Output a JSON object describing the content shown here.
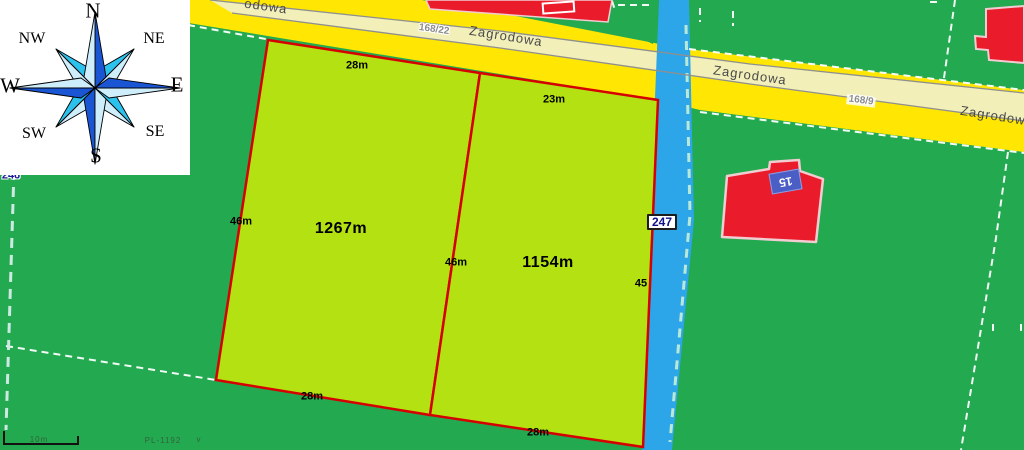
{
  "map_title": "cadastral parcel map",
  "compass": {
    "n": "N",
    "ne": "NE",
    "e": "E",
    "se": "SE",
    "s": "S",
    "sw": "SW",
    "w": "W",
    "nw": "NW"
  },
  "roads": {
    "name": "Zagrodowa",
    "name_partial": "odowa",
    "plot_number_left": "168/22",
    "plot_number_right": "168/9"
  },
  "parcels": {
    "parcel1": {
      "area_label": "1267m",
      "top": "28m",
      "left": "46m",
      "right": "46m",
      "bottom": "28m"
    },
    "parcel2": {
      "area_label": "1154m",
      "top": "23m",
      "right": "45",
      "bottom": "28m"
    }
  },
  "waterway": {
    "number": "247"
  },
  "neighbor_parcel_number": "246",
  "building": {
    "house_number": "15"
  },
  "scale_bar": {
    "label": "10m"
  },
  "watermark": {
    "text": "PL-1192",
    "mark": "v"
  },
  "colors": {
    "field_green": "#23a950",
    "parcel_green": "#b4e112",
    "road_yellow": "#ffe703",
    "road_center_band": "#f2efb9",
    "water_blue": "#2ca6e8",
    "parcel_border_red": "#d60000",
    "building_red": "#ea1c2c",
    "house_badge_blue": "#4b5ec6",
    "compass_dark_blue": "#1a56d4",
    "compass_cyan": "#2cc2ee",
    "compass_pale": "#cfeefb"
  }
}
